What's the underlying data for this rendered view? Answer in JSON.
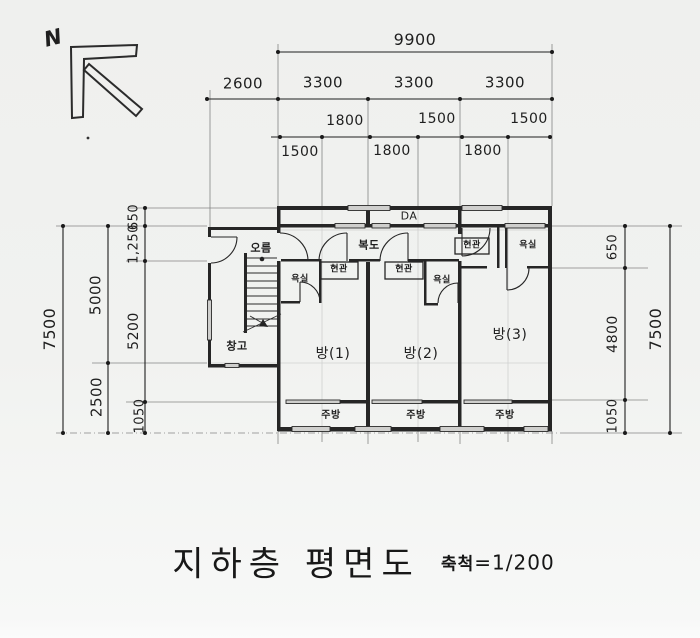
{
  "page": {
    "paper_color": "#f1f2f0",
    "ink_color": "#1f1f1f",
    "wall_color": "#262626",
    "window_fill": "#cfcfcd"
  },
  "north": {
    "label": "N"
  },
  "title": {
    "text": "지하층 평면도",
    "scale_prefix": "축척",
    "scale_value": "=1/200"
  },
  "dimensions": {
    "top_total": "9900",
    "top_bays": [
      "2600",
      "3300",
      "3300",
      "3300"
    ],
    "top_sub_upper": [
      "1800",
      "1500",
      "1500"
    ],
    "top_sub_lower": [
      "1500",
      "1800",
      "1800"
    ],
    "left_outer": "7500",
    "left_middle": [
      "5000",
      "2500"
    ],
    "left_inner": [
      "650",
      "1,250",
      "5200",
      "1050"
    ],
    "right_outer": "7500",
    "right_inner": [
      "650",
      "4800",
      "1050"
    ]
  },
  "rooms": {
    "duct": "DA",
    "stair_hall": "오름",
    "corridor": "복도",
    "storage": "창고",
    "entrances": [
      "현관",
      "현관",
      "현관"
    ],
    "bathrooms": [
      "욕실",
      "욕실",
      "욕실"
    ],
    "bedrooms": [
      "방(1)",
      "방(2)",
      "방(3)"
    ],
    "kitchens": [
      "주방",
      "주방",
      "주방"
    ]
  }
}
